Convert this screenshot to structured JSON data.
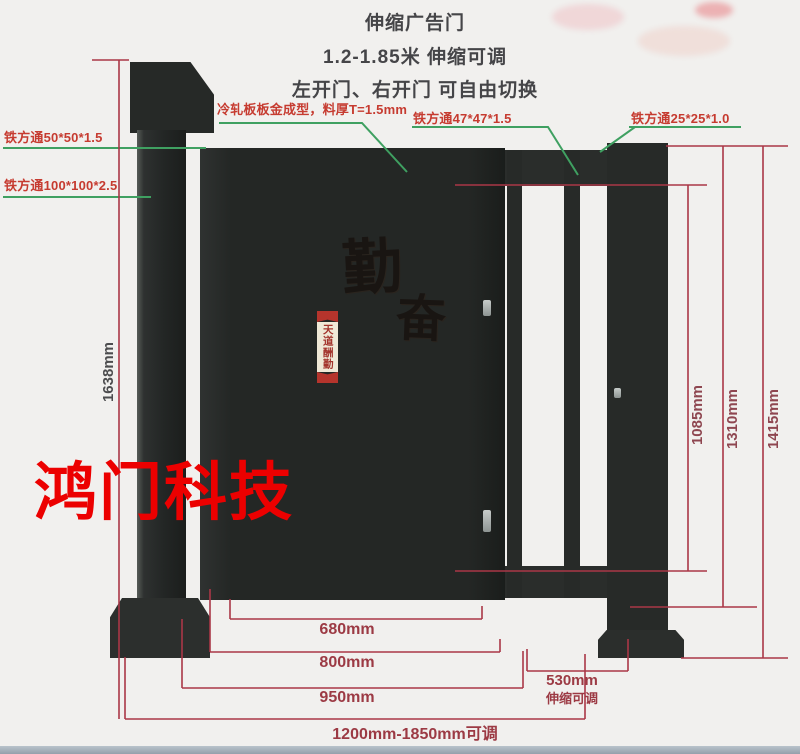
{
  "title_block": {
    "line1": "伸缩广告门",
    "line2": "1.2-1.85米 伸缩可调",
    "line3": "左开门、右开门 可自由切换"
  },
  "part_labels": {
    "tube_50": "铁方通50*50*1.5",
    "tube_100": "铁方通100*100*2.5",
    "cold_rolled_plate": "冷轧板板金成型，料厚T=1.5mm",
    "tube_47": "铁方通47*47*1.5",
    "tube_25": "铁方通25*25*1.0"
  },
  "dimensions": {
    "left_total_height": "1638mm",
    "door_panel_height": "1085mm",
    "slide_frame_height": "1310mm",
    "post_height": "1415mm",
    "poster_width": "680mm",
    "door_width": "800mm",
    "door_outer_width": "950mm",
    "slide_width": "530mm",
    "slide_note": "伸缩可调",
    "total_width": "1200mm-1850mm可调"
  },
  "watermark": "鸿门科技",
  "poster": {
    "big_char_1": "勤",
    "big_char_2": "奋",
    "ribbon_text": "天道酬勤"
  },
  "colors": {
    "dimension_red": "#aa3747",
    "leader_green": "#3fa061",
    "label_red": "#c63b30",
    "gate_dark": "#262927",
    "poster_cream": "#ece4d0",
    "watermark_red": "#ec0000"
  }
}
